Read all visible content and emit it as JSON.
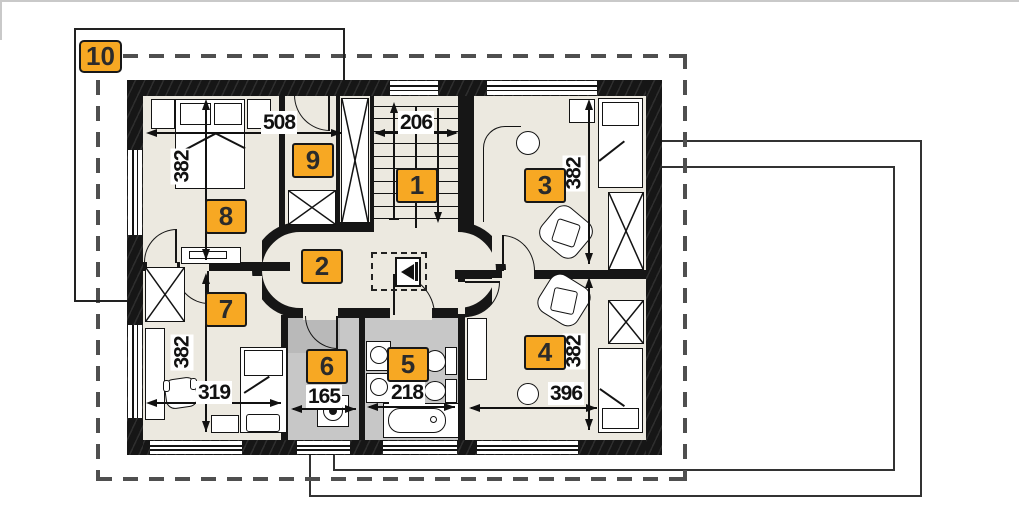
{
  "plan_title": "attic floor plan",
  "room_labels": [
    "1",
    "2",
    "3",
    "4",
    "5",
    "6",
    "7",
    "8",
    "9",
    "10"
  ],
  "dims": {
    "508": "508",
    "206": "206",
    "382": "382",
    "319": "319",
    "165": "165",
    "218": "218",
    "396": "396"
  },
  "colors": {
    "label_box": "#f7a823",
    "wall": "#161616",
    "floor": "#ece9e0",
    "wet_room_floor": "#c7c7c7",
    "roof_outline_dash": "#4f4f4f",
    "background": "#ffffff"
  },
  "icons": [
    "stairs-icon",
    "wardrobe-icon",
    "double-bed-icon",
    "single-bed-icon",
    "armchair-icon",
    "stool-icon",
    "desk-icon",
    "radiator-icon",
    "washing-machine-icon",
    "sink-icon",
    "toilet-icon",
    "bidet-icon",
    "bathtub-icon",
    "attic-hatch-icon",
    "door-arc-icon"
  ]
}
